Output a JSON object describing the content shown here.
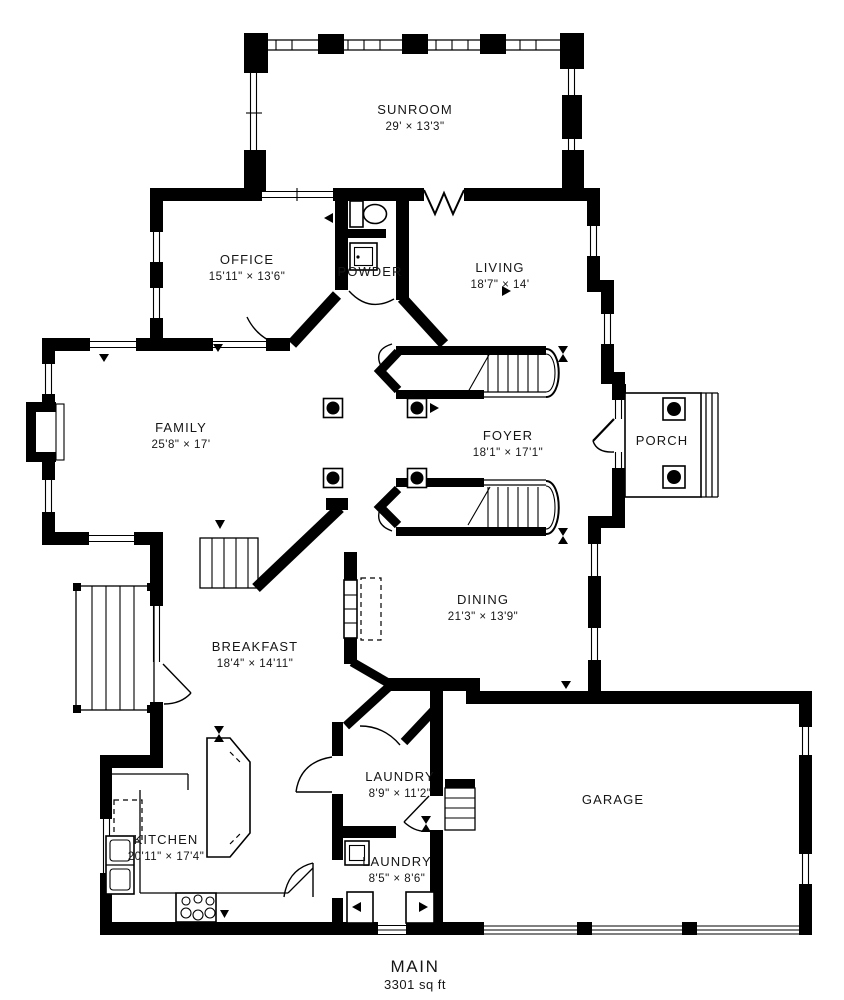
{
  "plan": {
    "floor_label": "MAIN",
    "floor_area": "3301 sq ft"
  },
  "rooms": {
    "sunroom": {
      "name": "SUNROOM",
      "dims": "29' × 13'3\""
    },
    "office": {
      "name": "OFFICE",
      "dims": "15'11\" × 13'6\""
    },
    "powder": {
      "name": "POWDER"
    },
    "living": {
      "name": "LIVING",
      "dims": "18'7\" × 14'"
    },
    "family": {
      "name": "FAMILY",
      "dims": "25'8\" × 17'"
    },
    "foyer": {
      "name": "FOYER",
      "dims": "18'1\" × 17'1\""
    },
    "porch": {
      "name": "PORCH"
    },
    "dining": {
      "name": "DINING",
      "dims": "21'3\" × 13'9\""
    },
    "breakfast": {
      "name": "BREAKFAST",
      "dims": "18'4\" × 14'11\""
    },
    "kitchen": {
      "name": "KITCHEN",
      "dims": "20'11\" × 17'4\""
    },
    "laundry_upper": {
      "name": "LAUNDRY",
      "dims": "8'9\" × 11'2\""
    },
    "laundry_lower": {
      "name": "LAUNDRY",
      "dims": "8'5\" × 8'6\""
    },
    "garage": {
      "name": "GARAGE"
    }
  },
  "colors": {
    "wall": "#000000",
    "background": "#ffffff",
    "text": "#161616"
  }
}
